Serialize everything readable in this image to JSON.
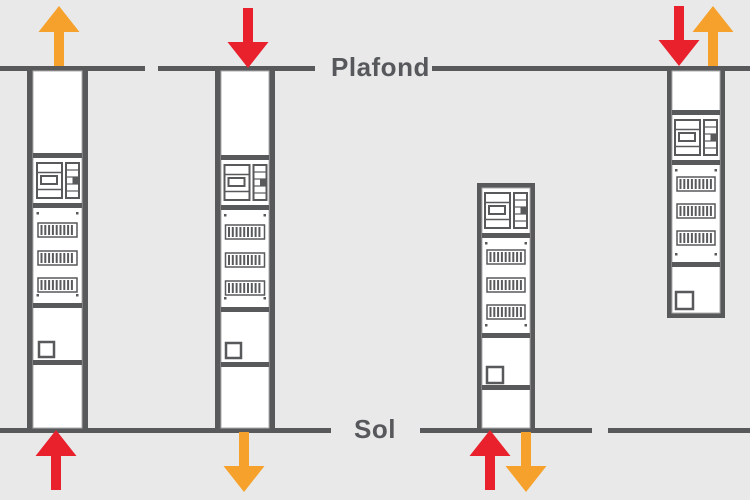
{
  "diagram": {
    "ceiling_label": "Plafond",
    "floor_label": "Sol",
    "background_color": "#E9E9EA",
    "structure_color": "#58595B",
    "legend_colors": {
      "red": "#E8212D",
      "orange": "#F5A12B"
    },
    "panels": [
      {
        "id": "panel-1",
        "position": "far-left",
        "extent": "ceiling-to-floor",
        "breaker_rows": 3,
        "arrows": [
          {
            "location": "above-ceiling",
            "direction": "up",
            "color_name": "orange",
            "color_hex": "#F5A12B"
          },
          {
            "location": "below-floor",
            "direction": "up",
            "color_name": "red",
            "color_hex": "#E8212D"
          }
        ]
      },
      {
        "id": "panel-2",
        "position": "center-left",
        "extent": "ceiling-to-floor",
        "breaker_rows": 3,
        "arrows": [
          {
            "location": "above-ceiling",
            "direction": "down",
            "color_name": "red",
            "color_hex": "#E8212D"
          },
          {
            "location": "below-floor",
            "direction": "down",
            "color_name": "orange",
            "color_hex": "#F5A12B"
          }
        ]
      },
      {
        "id": "panel-3",
        "position": "center-right",
        "extent": "floor-standing",
        "breaker_rows": 3,
        "arrows": [
          {
            "location": "below-floor",
            "direction": "up",
            "color_name": "red",
            "color_hex": "#E8212D"
          },
          {
            "location": "below-floor",
            "direction": "down",
            "color_name": "orange",
            "color_hex": "#F5A12B"
          }
        ]
      },
      {
        "id": "panel-4",
        "position": "far-right",
        "extent": "ceiling-hung",
        "breaker_rows": 3,
        "arrows": [
          {
            "location": "above-ceiling",
            "direction": "down",
            "color_name": "red",
            "color_hex": "#E8212D"
          },
          {
            "location": "above-ceiling",
            "direction": "up",
            "color_name": "orange",
            "color_hex": "#F5A12B"
          }
        ]
      }
    ]
  }
}
